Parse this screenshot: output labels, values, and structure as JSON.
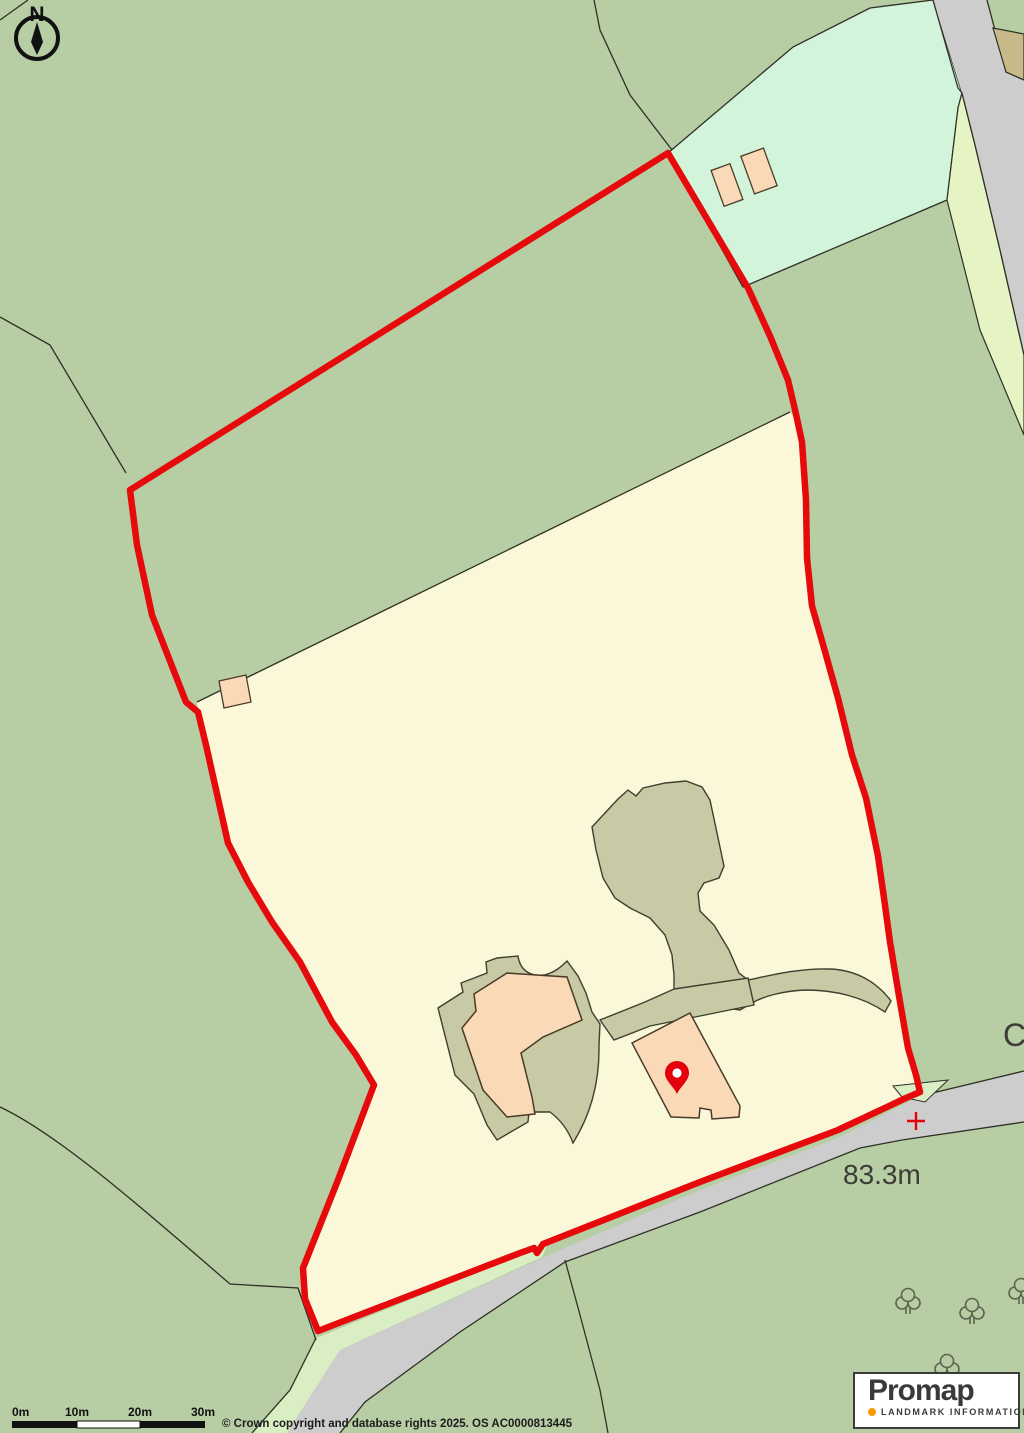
{
  "map": {
    "north_indicator": "N",
    "spot_height": "83.3m",
    "partial_road_label": "C"
  },
  "scale_bar": {
    "labels": [
      "0m",
      "10m",
      "20m",
      "30m"
    ]
  },
  "attribution": "© Crown copyright and database rights 2025. OS AC0000813445",
  "logo": {
    "brand": "Promap",
    "tagline": "LANDMARK INFORMATION"
  },
  "colors": {
    "boundary_red": "#e60a0c",
    "pin_red": "#e3000b",
    "cross_red": "#e3000b",
    "field_green": "#b7cda3",
    "light_field_mint": "#d2f4da",
    "parcel_cream": "#fbf8d9",
    "yard_khaki": "#c7caa4",
    "building_peach": "#f9d9b6",
    "road_gray": "#cecdce",
    "verge_green": "#d9eec3",
    "pale_strip": "#e6f4c4",
    "tan_strip": "#c7b98a",
    "logo_orange": "#f59b00"
  }
}
